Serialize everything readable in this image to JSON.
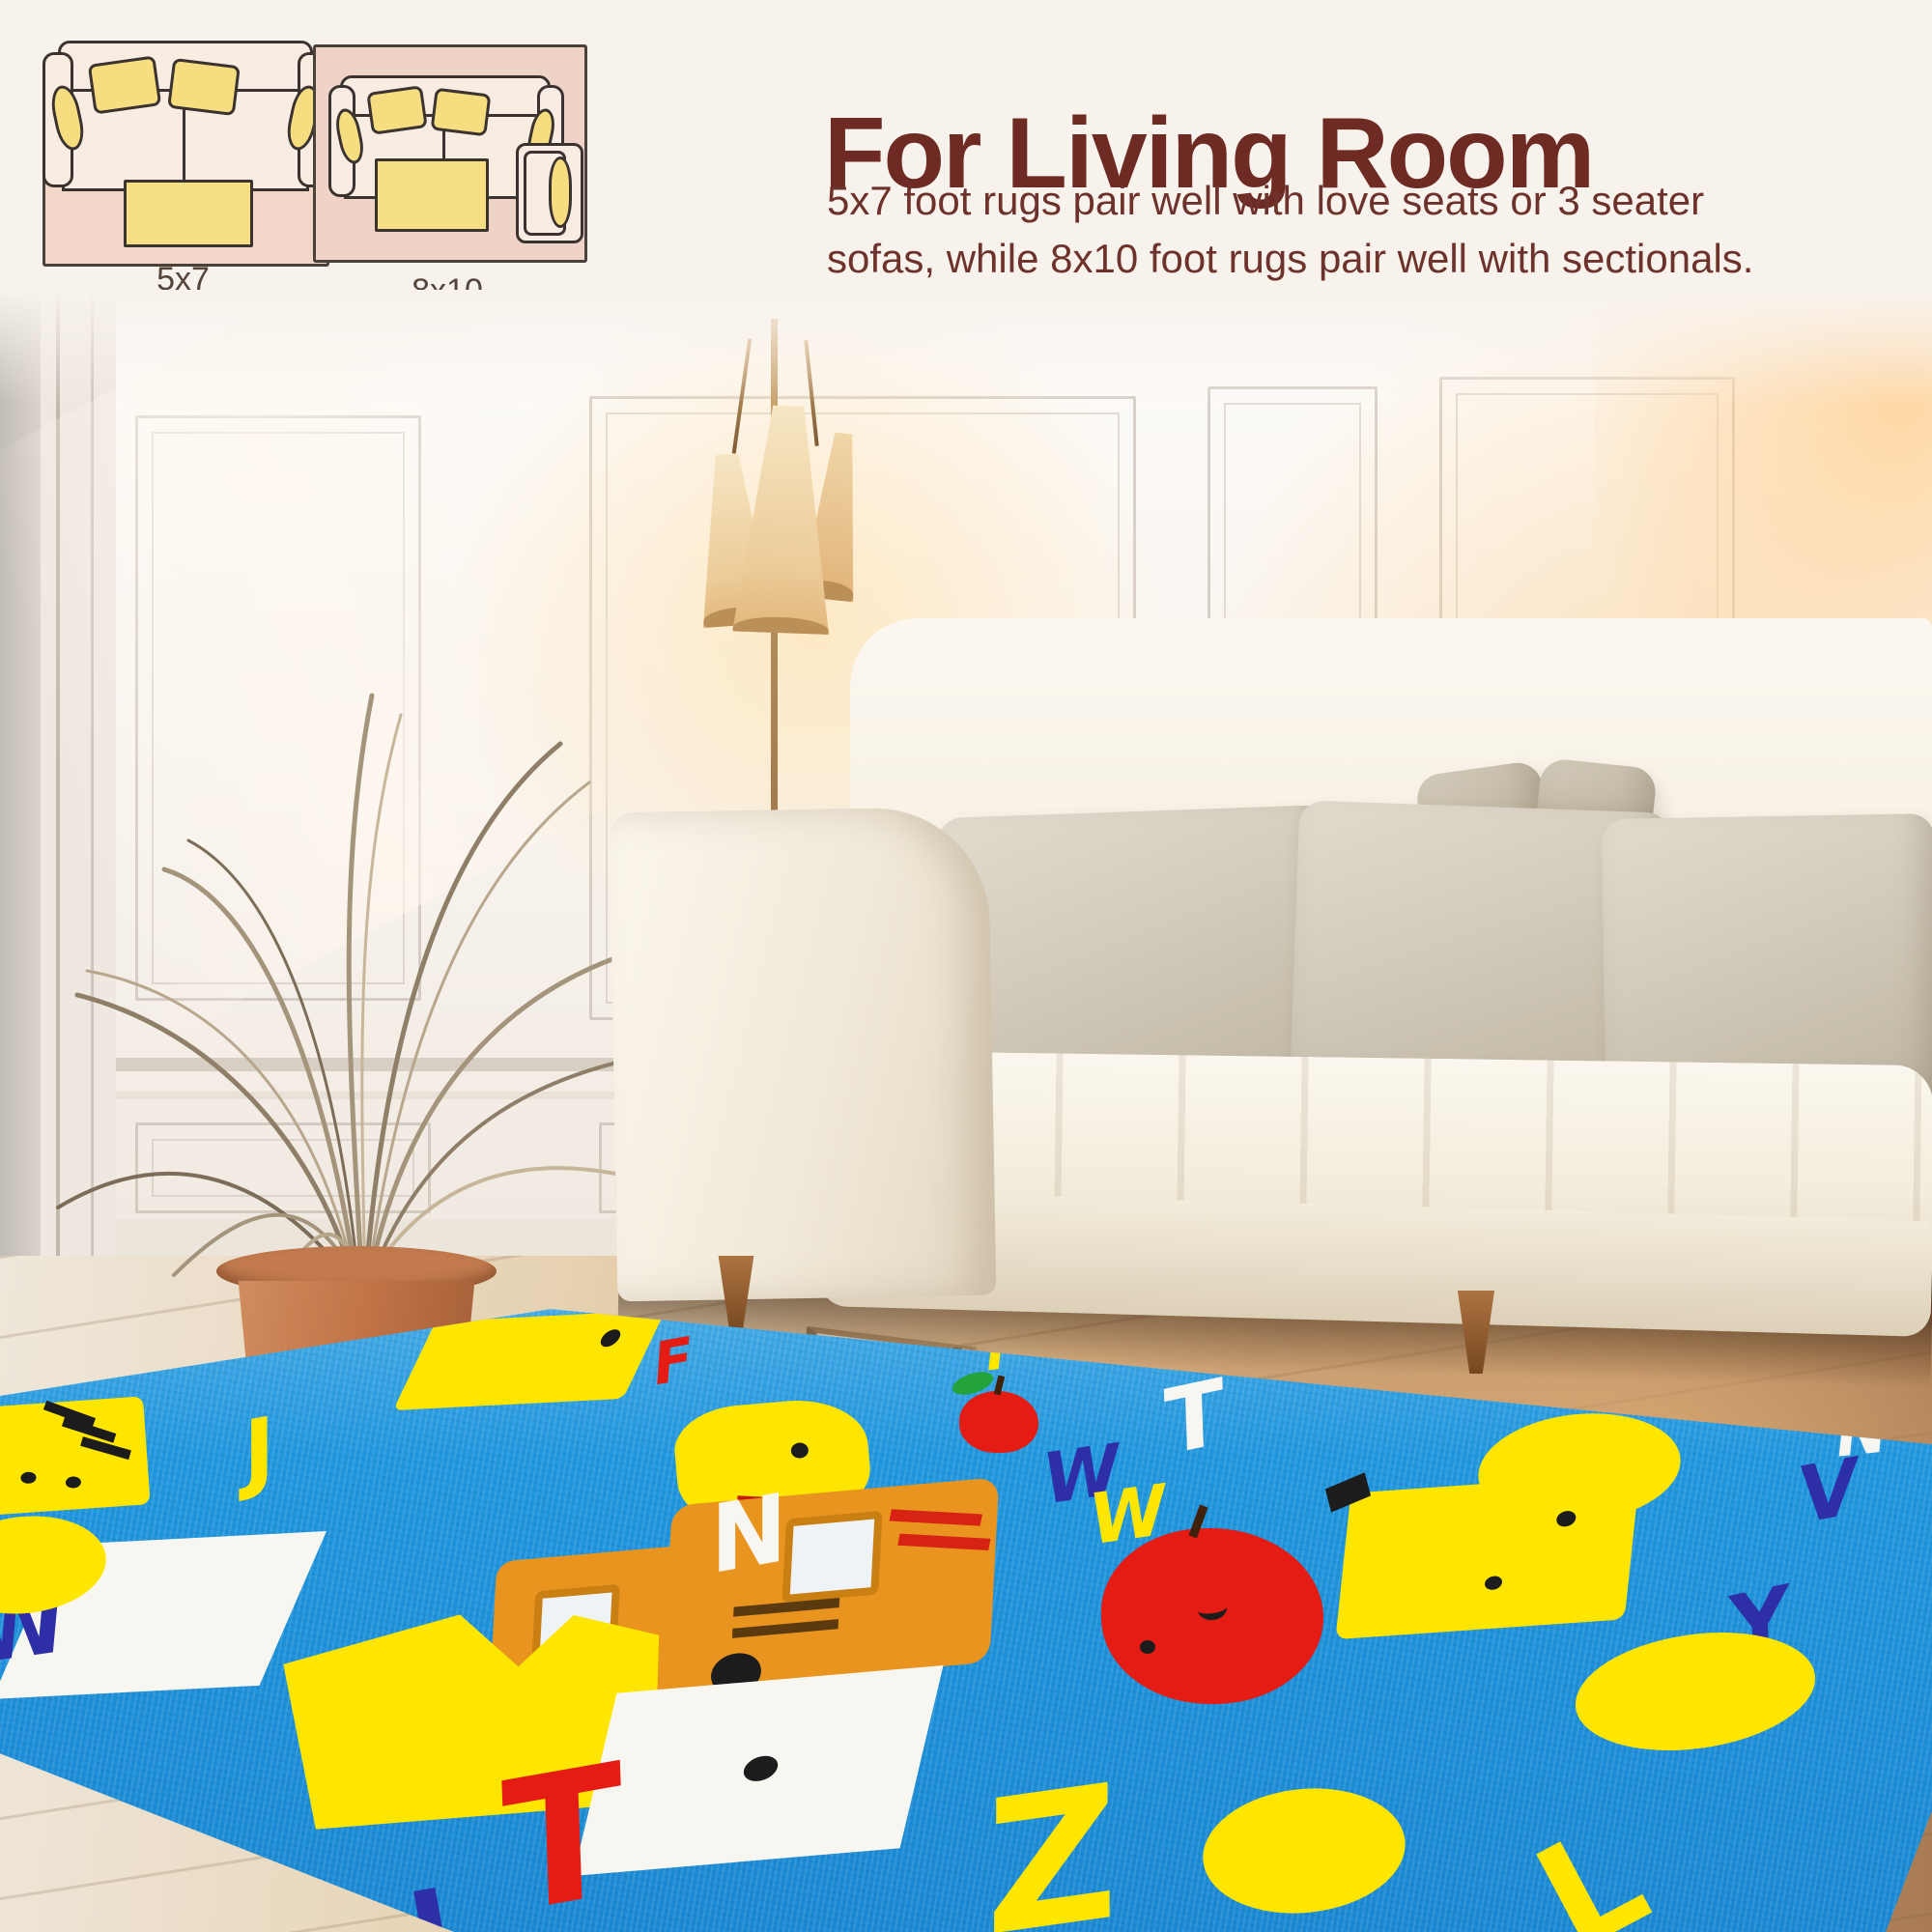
{
  "header": {
    "title": "For Living Room",
    "subtitle_line1": "5x7 foot rugs pair well with love seats or 3 seater",
    "subtitle_line2": "sofas, while 8x10 foot rugs pair well with sectionals."
  },
  "diagrams": {
    "small_label": "5x7",
    "large_label": "8x10"
  },
  "colors": {
    "background_cream": "#f8f2ec",
    "heading_maroon": "#6e2b24",
    "subtitle_maroon": "#6d322b",
    "diagram_label": "#55443a",
    "diagram_rug_pink": "#f2d7c9",
    "diagram_sofa_fill": "#f9ece3",
    "diagram_pillow_yellow": "#f6dd80",
    "diagram_outline": "#3a3330",
    "rug_blue": "#1e93da",
    "rug_yellow": "#ffe600",
    "rug_red": "#e41c13",
    "rug_white": "#f7f6f0",
    "rug_navy": "#2e2ea6",
    "rug_orange": "#e8941f",
    "rug_green": "#23a33a",
    "pot_terracotta": "#c07347",
    "sofa_cream": "#f6f0e2",
    "floor_wood": "#d3aa7c"
  },
  "rug": {
    "items": [
      {
        "name": "chick-icon",
        "color": "#ffe600"
      },
      {
        "name": "letter-f-red",
        "glyph": "F",
        "color": "#e41c13"
      },
      {
        "name": "letter-f-yellow",
        "glyph": "F",
        "color": "#ffe600"
      },
      {
        "name": "apple-small-icon",
        "color": "#e41c13"
      },
      {
        "name": "letter-n-white-top",
        "glyph": "N",
        "color": "#f7f6f0"
      },
      {
        "name": "tiger-face-icon",
        "color": "#ffe600"
      },
      {
        "name": "letter-j-yellow",
        "glyph": "J",
        "color": "#ffe600"
      },
      {
        "name": "duck-face-icon",
        "color": "#ffe600"
      },
      {
        "name": "letter-w-navy",
        "glyph": "W",
        "color": "#2e2ea6"
      },
      {
        "name": "letter-w-yellow",
        "glyph": "W",
        "color": "#ffe600"
      },
      {
        "name": "letter-t-white",
        "glyph": "T",
        "color": "#f7f6f0"
      },
      {
        "name": "circle-yellow",
        "color": "#ffe600"
      },
      {
        "name": "apple-big-icon",
        "color": "#e41c13"
      },
      {
        "name": "giraffe-face-icon",
        "color": "#ffe600"
      },
      {
        "name": "letter-v-navy",
        "glyph": "V",
        "color": "#2e2ea6"
      },
      {
        "name": "school-bus-icon",
        "color": "#e8941f"
      },
      {
        "name": "letter-n-white-mid",
        "glyph": "N",
        "color": "#f7f6f0"
      },
      {
        "name": "heart-yellow-icon",
        "color": "#ffe600"
      },
      {
        "name": "white-card-icon",
        "color": "#f7f6f0"
      },
      {
        "name": "white-square-dot-icon",
        "color": "#f7f6f0"
      },
      {
        "name": "letter-y-navy",
        "glyph": "Y",
        "color": "#2e2ea6"
      },
      {
        "name": "oval-yellow",
        "color": "#ffe600"
      },
      {
        "name": "circle-yellow-bottom",
        "color": "#ffe600"
      },
      {
        "name": "letter-t-red",
        "glyph": "T",
        "color": "#e41c13"
      },
      {
        "name": "letter-l-navy",
        "glyph": "L",
        "color": "#2e2ea6"
      },
      {
        "name": "letter-z-yellow",
        "glyph": "Z",
        "color": "#ffe600"
      },
      {
        "name": "letter-l-yellow",
        "glyph": "L",
        "color": "#ffe600"
      },
      {
        "name": "letter-w-navy-left",
        "glyph": "W",
        "color": "#2e2ea6"
      },
      {
        "name": "circle-yellow-left",
        "color": "#ffe600"
      }
    ]
  }
}
